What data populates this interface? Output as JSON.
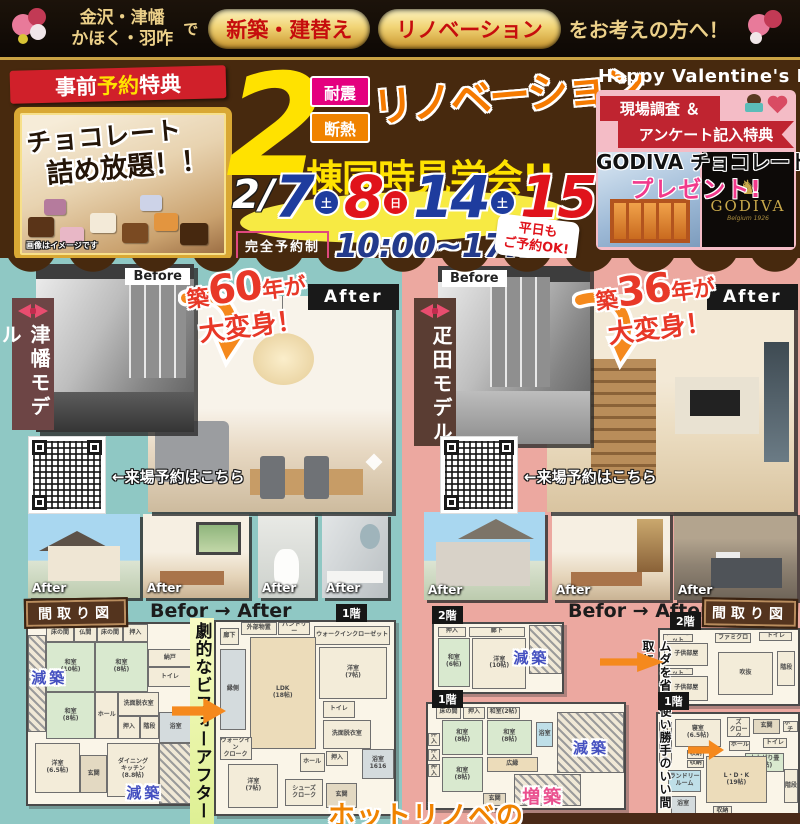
{
  "top_bar": {
    "region_line1": "金沢・津幡",
    "region_line2": "かほく・羽咋",
    "de": "で",
    "pill_new": "新築・建替え",
    "pill_reno": "リノベーション",
    "tail": "をお考えの方へ！"
  },
  "header": {
    "presale": {
      "ribbon_1": "事前",
      "ribbon_2": "予約",
      "ribbon_3": "特典",
      "title_line1": "チョコレート",
      "title_line2": "詰め放題！！",
      "note": "画像はイメージです"
    },
    "event": {
      "big_number": "2",
      "badge_taishin": "耐震",
      "badge_dannetsu": "断熱",
      "renovation": "リノベーション",
      "subtitle": "棟同時見学会!!",
      "date_prefix": "2/",
      "dates": [
        {
          "day": "7",
          "dow": "土"
        },
        {
          "day": "8",
          "dow": "日"
        },
        {
          "day": "14",
          "dow": "土"
        },
        {
          "day": "15",
          "dow": "日"
        }
      ],
      "reservation": "完全予約制",
      "time": "10:00~17:00",
      "weekday_note_line1": "平日も",
      "weekday_note_line2": "ご予約OK!"
    },
    "valentine": {
      "title": "Happy Valentine's Day",
      "ribbon_line1": "現場調査 ＆",
      "ribbon_line2": "アンケート記入特典",
      "gift_line1": "GODIVA チョコレート",
      "gift_line2": "プレゼント!",
      "logo": "GODIVA",
      "logo_sub": "Belgium 1926"
    }
  },
  "left_model": {
    "name": "津幡モデル",
    "before_label": "Before",
    "after_label": "After",
    "age_prefix": "築",
    "age_number": "60",
    "age_suffix": "年が",
    "transform_line2": "大変身！",
    "qr_caption": "←来場予約はこちら",
    "strip": [
      "After",
      "After",
      "After",
      "After"
    ],
    "plan_title": "間取り図",
    "befor_after": "Befor → After",
    "badge_1f": "1階",
    "center_text": "劇的なビフォーアフター"
  },
  "right_model": {
    "name": "疋田モデル",
    "before_label": "Before",
    "after_label": "After",
    "age_prefix": "築",
    "age_number": "36",
    "age_suffix": "年が",
    "transform_line2": "大変身！",
    "qr_caption": "←来場予約はこちら",
    "strip": [
      "After",
      "After",
      "After"
    ],
    "plan_title": "間取り図",
    "befor_after": "Befor → After",
    "badge_2f": "2階",
    "badge_1f": "1階",
    "center_text": "ムダを省き使い勝手のいい間取に"
  },
  "bottom": {
    "hot_renove": "ホットリノベの"
  },
  "colors": {
    "header_brown": "#47290e",
    "left_bg_teal": "#8fc8c4",
    "right_bg_pink": "#eca8a0",
    "accent_yellow": "#ffe200",
    "accent_orange": "#f57a00",
    "date_blue": "#1e3c9e",
    "date_red": "#e0131b",
    "genchiku_blue": "#4450c0",
    "zochiku_pink": "#ea4f8e"
  },
  "floorplans": {
    "left_before": {
      "rooms": [
        {
          "t": "縁側",
          "x": 0,
          "y": 6,
          "w": 11,
          "h": 54,
          "c": "hatch"
        },
        {
          "t": "床の間",
          "x": 11,
          "y": 0,
          "w": 17,
          "h": 10
        },
        {
          "t": "仏間",
          "x": 28,
          "y": 0,
          "w": 14,
          "h": 10
        },
        {
          "t": "床の間",
          "x": 42,
          "y": 0,
          "w": 16,
          "h": 10
        },
        {
          "t": "押入",
          "x": 58,
          "y": 0,
          "w": 15,
          "h": 10
        },
        {
          "t": "和室\n(10帖)",
          "x": 11,
          "y": 10,
          "w": 30,
          "h": 28,
          "c": "tatami"
        },
        {
          "t": "和室\n(8帖)",
          "x": 41,
          "y": 10,
          "w": 32,
          "h": 28,
          "c": "tatami"
        },
        {
          "t": "納戸",
          "x": 73,
          "y": 14,
          "w": 27,
          "h": 10
        },
        {
          "t": "トイレ",
          "x": 73,
          "y": 24,
          "w": 27,
          "h": 11
        },
        {
          "t": "和室\n(8帖)",
          "x": 11,
          "y": 38,
          "w": 30,
          "h": 26,
          "c": "tatami"
        },
        {
          "t": "ホール",
          "x": 41,
          "y": 38,
          "w": 14,
          "h": 26
        },
        {
          "t": "洗面脱衣室",
          "x": 55,
          "y": 38,
          "w": 25,
          "h": 13
        },
        {
          "t": "押入",
          "x": 55,
          "y": 51,
          "w": 13,
          "h": 13
        },
        {
          "t": "階段",
          "x": 68,
          "y": 51,
          "w": 12,
          "h": 13
        },
        {
          "t": "浴室",
          "x": 80,
          "y": 49,
          "w": 20,
          "h": 17,
          "c": "bath"
        },
        {
          "t": "洋室\n(6.5帖)",
          "x": 4,
          "y": 66,
          "w": 28,
          "h": 28
        },
        {
          "t": "玄関",
          "x": 32,
          "y": 73,
          "w": 16,
          "h": 21,
          "c": "genkan"
        },
        {
          "t": "ダイニング\nキッチン\n(8.8帖)",
          "x": 48,
          "y": 66,
          "w": 32,
          "h": 30
        },
        {
          "t": "",
          "x": 80,
          "y": 66,
          "w": 20,
          "h": 34,
          "c": "hatch"
        }
      ],
      "overlays": [
        {
          "t": "減築",
          "x": 2,
          "y": 24,
          "cls": "genchiku"
        },
        {
          "t": "減築",
          "x": 60,
          "y": 88,
          "cls": "genchiku"
        }
      ]
    },
    "left_after": {
      "rooms": [
        {
          "t": "廊下",
          "x": 2,
          "y": 3,
          "w": 11,
          "h": 9
        },
        {
          "t": "外部物置",
          "x": 14,
          "y": 0,
          "w": 20,
          "h": 7
        },
        {
          "t": "パントリー",
          "x": 35,
          "y": 0,
          "w": 18,
          "h": 7
        },
        {
          "t": "ウォークインクローゼット",
          "x": 55,
          "y": 2,
          "w": 43,
          "h": 10
        },
        {
          "t": "洋室\n(7帖)",
          "x": 58,
          "y": 13,
          "w": 38,
          "h": 27
        },
        {
          "t": "LDK\n(18帖)",
          "x": 19,
          "y": 8,
          "w": 37,
          "h": 58,
          "c": "wood"
        },
        {
          "t": "縁側",
          "x": 2,
          "y": 14,
          "w": 15,
          "h": 42,
          "c": "bath"
        },
        {
          "t": "トイレ",
          "x": 60,
          "y": 41,
          "w": 18,
          "h": 9
        },
        {
          "t": "洗面脱衣室",
          "x": 60,
          "y": 51,
          "w": 27,
          "h": 15
        },
        {
          "t": "ホール",
          "x": 47,
          "y": 68,
          "w": 14,
          "h": 10
        },
        {
          "t": "押入",
          "x": 62,
          "y": 67,
          "w": 12,
          "h": 8
        },
        {
          "t": "浴室\n1616",
          "x": 82,
          "y": 66,
          "w": 18,
          "h": 16,
          "c": "bath"
        },
        {
          "t": "ウォークイン\nクローク",
          "x": 2,
          "y": 60,
          "w": 18,
          "h": 12
        },
        {
          "t": "洋室\n(7帖)",
          "x": 7,
          "y": 74,
          "w": 28,
          "h": 23
        },
        {
          "t": "シューズ\nクローク",
          "x": 39,
          "y": 82,
          "w": 21,
          "h": 14
        },
        {
          "t": "玄関",
          "x": 62,
          "y": 84,
          "w": 17,
          "h": 13,
          "c": "genkan"
        }
      ],
      "overlays": []
    },
    "right_before_2f": {
      "rooms": [
        {
          "t": "押入",
          "x": 3,
          "y": 4,
          "w": 22,
          "h": 15
        },
        {
          "t": "廊下",
          "x": 27,
          "y": 4,
          "w": 44,
          "h": 15
        },
        {
          "t": "和室\n(6帖)",
          "x": 3,
          "y": 20,
          "w": 25,
          "h": 72,
          "c": "tatami"
        },
        {
          "t": "洋室\n(10帖)",
          "x": 30,
          "y": 20,
          "w": 42,
          "h": 76
        },
        {
          "t": "",
          "x": 74,
          "y": 2,
          "w": 26,
          "h": 72,
          "c": "hatch"
        }
      ],
      "overlays": [
        {
          "t": "減築",
          "x": 62,
          "y": 34,
          "cls": "genchiku"
        }
      ]
    },
    "right_before_1f": {
      "rooms": [
        {
          "t": "床の間",
          "x": 4,
          "y": 3,
          "w": 13,
          "h": 11
        },
        {
          "t": "押入",
          "x": 18,
          "y": 3,
          "w": 11,
          "h": 11
        },
        {
          "t": "和室(2帖)",
          "x": 30,
          "y": 3,
          "w": 17,
          "h": 11
        },
        {
          "t": "押入",
          "x": 0,
          "y": 28,
          "w": 6,
          "h": 12
        },
        {
          "t": "押入",
          "x": 0,
          "y": 43,
          "w": 6,
          "h": 12
        },
        {
          "t": "押入",
          "x": 0,
          "y": 58,
          "w": 6,
          "h": 12
        },
        {
          "t": "和室\n(8帖)",
          "x": 7,
          "y": 15,
          "w": 21,
          "h": 34,
          "c": "tatami"
        },
        {
          "t": "和室\n(8帖)",
          "x": 30,
          "y": 15,
          "w": 23,
          "h": 34,
          "c": "tatami"
        },
        {
          "t": "浴室",
          "x": 55,
          "y": 17,
          "w": 9,
          "h": 24,
          "c": "blue"
        },
        {
          "t": "和室\n(8帖)",
          "x": 7,
          "y": 51,
          "w": 21,
          "h": 34,
          "c": "tatami"
        },
        {
          "t": "広縁",
          "x": 30,
          "y": 51,
          "w": 26,
          "h": 14,
          "c": "wood"
        },
        {
          "t": "玄関",
          "x": 28,
          "y": 86,
          "w": 12,
          "h": 12,
          "c": "genkan"
        },
        {
          "t": "",
          "x": 44,
          "y": 67,
          "w": 34,
          "h": 31,
          "c": "hatch"
        },
        {
          "t": "",
          "x": 66,
          "y": 8,
          "w": 34,
          "h": 58,
          "c": "hatch"
        }
      ],
      "overlays": [
        {
          "t": "増築",
          "x": 48,
          "y": 76,
          "cls": "zochiku"
        },
        {
          "t": "減築",
          "x": 74,
          "y": 32,
          "cls": "genchiku"
        }
      ]
    },
    "right_after_2f": {
      "rooms": [
        {
          "t": "クローゼット",
          "x": 2,
          "y": 6,
          "w": 22,
          "h": 10
        },
        {
          "t": "子供部屋",
          "x": 3,
          "y": 17,
          "w": 32,
          "h": 32
        },
        {
          "t": "クローゼット",
          "x": 2,
          "y": 51,
          "w": 22,
          "h": 10
        },
        {
          "t": "子供部屋",
          "x": 3,
          "y": 62,
          "w": 32,
          "h": 34
        },
        {
          "t": "ファミクロ",
          "x": 40,
          "y": 4,
          "w": 26,
          "h": 14
        },
        {
          "t": "トイレ",
          "x": 72,
          "y": 3,
          "w": 24,
          "h": 12
        },
        {
          "t": "吹抜",
          "x": 42,
          "y": 30,
          "w": 40,
          "h": 58
        },
        {
          "t": "階段",
          "x": 85,
          "y": 28,
          "w": 13,
          "h": 48
        }
      ],
      "overlays": []
    },
    "right_after_1f": {
      "rooms": [
        {
          "t": "クローゼット",
          "x": 1,
          "y": 8,
          "w": 9,
          "h": 38
        },
        {
          "t": "寝室\n(6.5帖)",
          "x": 12,
          "y": 5,
          "w": 33,
          "h": 26
        },
        {
          "t": "シューズ\nクローク",
          "x": 49,
          "y": 3,
          "w": 17,
          "h": 19
        },
        {
          "t": "玄関",
          "x": 68,
          "y": 5,
          "w": 19,
          "h": 14,
          "c": "genkan"
        },
        {
          "t": "ポーチ",
          "x": 89,
          "y": 7,
          "w": 11,
          "h": 10
        },
        {
          "t": "ホール",
          "x": 51,
          "y": 25,
          "w": 15,
          "h": 10
        },
        {
          "t": "トイレ",
          "x": 75,
          "y": 23,
          "w": 17,
          "h": 9
        },
        {
          "t": "収納",
          "x": 21,
          "y": 34,
          "w": 12,
          "h": 8
        },
        {
          "t": "収納",
          "x": 21,
          "y": 43,
          "w": 12,
          "h": 8
        },
        {
          "t": "小上がり畳\n(3帖)",
          "x": 62,
          "y": 37,
          "w": 28,
          "h": 18,
          "c": "tatami"
        },
        {
          "t": "ランドリー\nルーム",
          "x": 7,
          "y": 53,
          "w": 24,
          "h": 21,
          "c": "blue"
        },
        {
          "t": "L・D・K\n(19帖)",
          "x": 34,
          "y": 40,
          "w": 44,
          "h": 44,
          "c": "wood"
        },
        {
          "t": "浴室",
          "x": 9,
          "y": 77,
          "w": 18,
          "h": 17,
          "c": "bath"
        },
        {
          "t": "収納",
          "x": 39,
          "y": 87,
          "w": 14,
          "h": 9
        },
        {
          "t": "階段",
          "x": 90,
          "y": 52,
          "w": 10,
          "h": 32
        }
      ],
      "overlays": []
    }
  }
}
